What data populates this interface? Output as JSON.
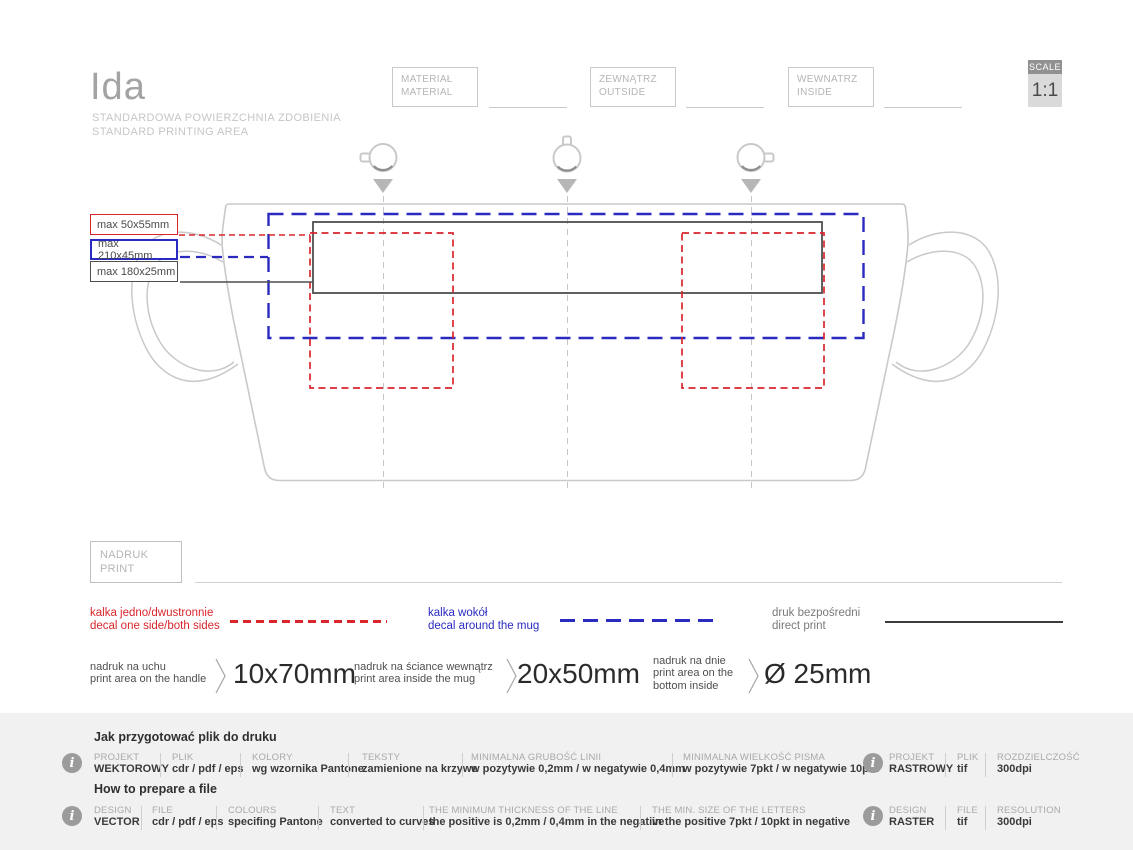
{
  "colors": {
    "accent_red": "#d8262c",
    "accent_blue": "#2a2ac0",
    "outline_gray": "#c9c9c9",
    "dark_line": "#4f4f4f",
    "footer_bg": "#f1f1f1"
  },
  "icons": {
    "info_glyph": "i"
  },
  "header": {
    "title": "Ida",
    "subtitle_pl": "STANDARDOWA POWIERZCHNIA ZDOBIENIA",
    "subtitle_en": "STANDARD PRINTING AREA",
    "fields": [
      {
        "pl": "MATERIAŁ",
        "en": "MATERIAL"
      },
      {
        "pl": "ZEWNĄTRZ",
        "en": "OUTSIDE"
      },
      {
        "pl": "WEWNATRZ",
        "en": "INSIDE"
      }
    ],
    "scale": {
      "label": "SCALE",
      "value": "1:1"
    }
  },
  "diagram": {
    "max_labels": [
      {
        "text": "max 50x55mm"
      },
      {
        "text": "max 210x45mm"
      },
      {
        "text": "max 180x25mm"
      }
    ]
  },
  "print_box": {
    "pl": "NADRUK",
    "en": "PRINT"
  },
  "legend": [
    {
      "pl": "kalka jedno/dwustronnie",
      "en": "decal one side/both sides"
    },
    {
      "pl": "kalka wokół",
      "en": "decal around the mug"
    },
    {
      "pl": "druk bezpośredni",
      "en": "direct print"
    }
  ],
  "measurements": [
    {
      "lines": [
        "nadruk na uchu",
        "print area on the handle"
      ],
      "value": "10x70mm"
    },
    {
      "lines": [
        "nadruk na ściance wewnątrz",
        "print area inside the mug"
      ],
      "value": "20x50mm"
    },
    {
      "lines": [
        "nadruk na dnie",
        "print area on the",
        "bottom inside"
      ],
      "value": "Ø 25mm"
    }
  ],
  "footer": {
    "pl": {
      "heading": "Jak przygotować plik do druku",
      "cols": [
        {
          "label": "PROJEKT",
          "value": "WEKTOROWY"
        },
        {
          "label": "PLIK",
          "value": "cdr / pdf / eps"
        },
        {
          "label": "KOLORY",
          "value": "wg wzornika Pantone"
        },
        {
          "label": "TEKSTY",
          "value": "zamienione na krzywe"
        },
        {
          "label": "MINIMALNA GRUBOŚĆ LINII",
          "value": "w pozytywie 0,2mm / w negatywie 0,4mm"
        },
        {
          "label": "MINIMALNA WIELKOŚĆ PISMA",
          "value": "w pozytywie 7pkt / w negatywie 10pkt"
        }
      ],
      "raster": [
        {
          "label": "PROJEKT",
          "value": "RASTROWY"
        },
        {
          "label": "PLIK",
          "value": "tif"
        },
        {
          "label": "ROZDZIELCZOŚĆ",
          "value": "300dpi"
        }
      ]
    },
    "en": {
      "heading": "How to prepare a file",
      "cols": [
        {
          "label": "DESIGN",
          "value": "VECTOR"
        },
        {
          "label": "FILE",
          "value": "cdr / pdf / eps"
        },
        {
          "label": "COLOURS",
          "value": "specifing Pantone"
        },
        {
          "label": "TEXT",
          "value": "converted to curves"
        },
        {
          "label": "THE MINIMUM THICKNESS OF THE LINE",
          "value": "the positive is 0,2mm / 0,4mm in the negative"
        },
        {
          "label": "THE MIN. SIZE OF THE LETTERS",
          "value": "in the positive 7pkt / 10pkt in negative"
        }
      ],
      "raster": [
        {
          "label": "DESIGN",
          "value": "RASTER"
        },
        {
          "label": "FILE",
          "value": "tif"
        },
        {
          "label": "RESOLUTION",
          "value": "300dpi"
        }
      ]
    }
  }
}
